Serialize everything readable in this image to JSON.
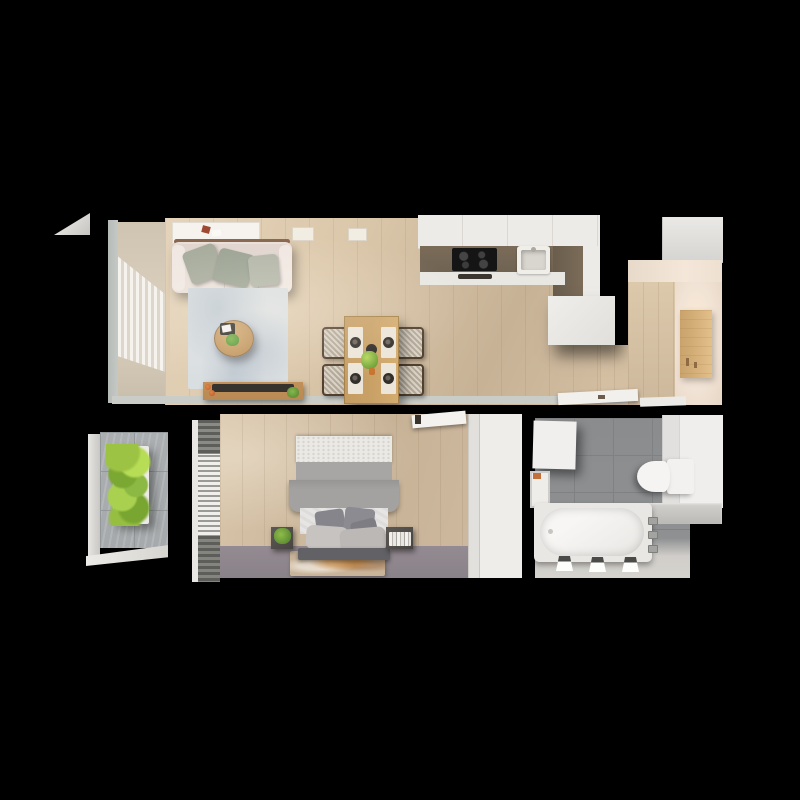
{
  "scene": {
    "type": "apartment-floor-plan-3d-top-down-render",
    "background": "#000000"
  },
  "palette": {
    "bg": "#000000",
    "wood-light": "#dcc8ab",
    "wood-dark": "#c7b296",
    "wood-door": "#d8b37c",
    "wall-gray": "#c5c9c5",
    "wall-beige": "#f1e3d5",
    "counter-white": "#edebe7",
    "counter-dark": "#6f6251",
    "cooktop-black": "#151515",
    "sofa-cream": "#e9dfda",
    "pillow-sage": "#a4a99a",
    "rug-blue": "#d9dee1",
    "table-wood": "#c9a166",
    "chair-frame": "#52402f",
    "bench-wood": "#b98a54",
    "carpet-mauve": "#8a8289",
    "bed-gray": "#a3a2a0",
    "blind-gray": "#74746f",
    "concrete-gray": "#a6aaac",
    "plant-green": "#8cb844",
    "tile-gray": "#8f9193",
    "fixture-white": "#f2f1ef",
    "accent-orange": "#c4703a"
  },
  "rooms": [
    {
      "id": "living-room",
      "furniture": [
        "sofa",
        "throw-pillows",
        "area-rug",
        "round-coffee-table",
        "media-bench",
        "dining-table",
        "dining-chairs",
        "window-curtains",
        "ceiling-light-panel"
      ]
    },
    {
      "id": "kitchen",
      "furniture": [
        "l-shaped-counter",
        "cooktop",
        "sink",
        "island-cabinet"
      ]
    },
    {
      "id": "hallway",
      "furniture": [
        "wardrobe-cabinet",
        "entry-door-panel",
        "open-interior-door"
      ]
    },
    {
      "id": "balcony",
      "furniture": [
        "vertical-garden-planter",
        "concrete-tile-floor"
      ]
    },
    {
      "id": "bedroom",
      "furniture": [
        "double-bed",
        "pillows",
        "nightstand-left-with-plant",
        "nightstand-right-with-books",
        "bedside-rug",
        "wardrobe",
        "window-blinds",
        "open-door"
      ]
    },
    {
      "id": "bathroom",
      "furniture": [
        "bathtub",
        "toilet",
        "vanity-cabinet",
        "wall-cabinets",
        "shelf-niche",
        "ceiling-spotlights"
      ]
    }
  ]
}
